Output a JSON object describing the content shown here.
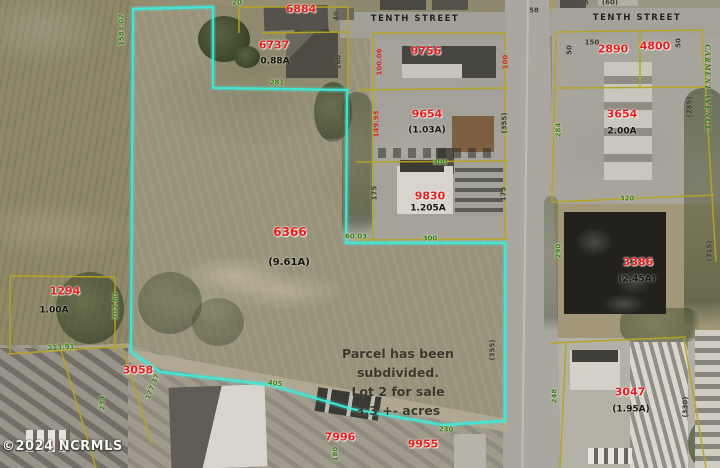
{
  "watermark": "©2024 NCRMLS",
  "annotation": {
    "line1": "Parcel has been subdivided.",
    "line2": "Lot 2 for sale",
    "line3": "3.3 +- acres"
  },
  "subject_parcel": {
    "id": "6366",
    "acreage": "(9.61A)"
  },
  "streets": [
    "TENTH STREET",
    "TENTH STREET",
    "CARMENT AVENUE"
  ],
  "colors": {
    "subject_outline": "#3fe8d7",
    "parcel_line": "#b7a51f",
    "parcel_id_red": "#e61c1c",
    "dim_green": "#33761c",
    "dim_dark": "#39392e"
  },
  "map": {
    "labels": [
      {
        "text": "TENTH STREET",
        "x": 415,
        "y": 19,
        "cls": "street",
        "size": 8.5,
        "sp": 1.5,
        "name": "street-label-tenth-street-west"
      },
      {
        "text": "TENTH STREET",
        "x": 637,
        "y": 18,
        "cls": "street",
        "size": 8.5,
        "sp": 1.5,
        "name": "street-label-tenth-street-east"
      },
      {
        "text": "CARMENT AVENUE",
        "x": 707,
        "y": 88,
        "rot": 90,
        "cls": "avenue",
        "size": 8,
        "sp": 1,
        "name": "street-label-carment-avenue"
      },
      {
        "text": "6884",
        "x": 301,
        "y": 9,
        "cls": "red",
        "size": 11,
        "name": "parcel-id-6884"
      },
      {
        "text": "6737",
        "x": 274,
        "y": 45,
        "cls": "red",
        "size": 11,
        "name": "parcel-id-6737"
      },
      {
        "text": "0.88A",
        "x": 275,
        "y": 62,
        "cls": "black",
        "size": 9,
        "name": "acreage-6737"
      },
      {
        "text": "9756",
        "x": 426,
        "y": 51,
        "cls": "red",
        "size": 11,
        "name": "parcel-id-9756"
      },
      {
        "text": "9654",
        "x": 427,
        "y": 114,
        "cls": "red",
        "size": 11,
        "name": "parcel-id-9654"
      },
      {
        "text": "(1.03A)",
        "x": 427,
        "y": 131,
        "cls": "black",
        "size": 9,
        "name": "acreage-9654"
      },
      {
        "text": "9830",
        "x": 430,
        "y": 196,
        "cls": "red",
        "size": 11,
        "name": "parcel-id-9830"
      },
      {
        "text": "1.205A",
        "x": 428,
        "y": 209,
        "cls": "black",
        "size": 9,
        "name": "acreage-9830"
      },
      {
        "text": "6366",
        "x": 290,
        "y": 232,
        "cls": "red",
        "size": 12,
        "name": "parcel-id-6366"
      },
      {
        "text": "(9.61A)",
        "x": 289,
        "y": 263,
        "cls": "black",
        "size": 10,
        "name": "acreage-6366"
      },
      {
        "text": "1294",
        "x": 65,
        "y": 291,
        "cls": "red",
        "size": 11,
        "name": "parcel-id-1294"
      },
      {
        "text": "1.00A",
        "x": 54,
        "y": 311,
        "cls": "black",
        "size": 9,
        "name": "acreage-1294"
      },
      {
        "text": "3058",
        "x": 138,
        "y": 370,
        "cls": "red",
        "size": 11,
        "name": "parcel-id-3058"
      },
      {
        "text": "7996",
        "x": 340,
        "y": 437,
        "cls": "red",
        "size": 11,
        "name": "parcel-id-7996"
      },
      {
        "text": "9955",
        "x": 423,
        "y": 444,
        "cls": "red",
        "size": 11,
        "name": "parcel-id-9955"
      },
      {
        "text": "2890",
        "x": 613,
        "y": 49,
        "cls": "red",
        "size": 11,
        "name": "parcel-id-2890"
      },
      {
        "text": "4800",
        "x": 655,
        "y": 46,
        "cls": "red",
        "size": 11,
        "name": "parcel-id-4800"
      },
      {
        "text": "3654",
        "x": 622,
        "y": 114,
        "cls": "red",
        "size": 11,
        "name": "parcel-id-3654"
      },
      {
        "text": "2.00A",
        "x": 622,
        "y": 132,
        "cls": "black",
        "size": 9,
        "name": "acreage-3654"
      },
      {
        "text": "3386",
        "x": 638,
        "y": 262,
        "cls": "red",
        "size": 11,
        "name": "parcel-id-3386"
      },
      {
        "text": "(2.45A)",
        "x": 637,
        "y": 280,
        "cls": "black",
        "size": 9,
        "name": "acreage-3386"
      },
      {
        "text": "3047",
        "x": 630,
        "y": 392,
        "cls": "red",
        "size": 11,
        "name": "parcel-id-3047"
      },
      {
        "text": "(1.95A)",
        "x": 631,
        "y": 410,
        "cls": "black",
        "size": 9,
        "name": "acreage-3047"
      },
      {
        "text": "1583.07",
        "x": 122,
        "y": 30,
        "rot": -90,
        "cls": "green",
        "size": 7,
        "name": "dim-1583-07"
      },
      {
        "text": "20",
        "x": 237,
        "y": 3,
        "cls": "green",
        "size": 7,
        "name": "dim-20"
      },
      {
        "text": "281",
        "x": 277,
        "y": 83,
        "cls": "green",
        "size": 7,
        "name": "dim-281"
      },
      {
        "text": "60.03",
        "x": 356,
        "y": 237,
        "cls": "green",
        "size": 7,
        "name": "dim-60-03"
      },
      {
        "text": "300",
        "x": 440,
        "y": 163,
        "cls": "green",
        "size": 7,
        "name": "dim-300-upper"
      },
      {
        "text": "300",
        "x": 430,
        "y": 239,
        "cls": "green",
        "size": 7,
        "name": "dim-300-lower"
      },
      {
        "text": "202.80",
        "x": 116,
        "y": 306,
        "rot": -90,
        "cls": "green",
        "size": 7,
        "name": "dim-202-80"
      },
      {
        "text": "213.91",
        "x": 61,
        "y": 348,
        "rot": -4,
        "cls": "green",
        "size": 7,
        "name": "dim-213-91"
      },
      {
        "text": "234",
        "x": 103,
        "y": 403,
        "rot": -90,
        "cls": "green",
        "size": 7,
        "name": "dim-234"
      },
      {
        "text": "177.37",
        "x": 153,
        "y": 387,
        "rot": -68,
        "cls": "green",
        "size": 7,
        "name": "dim-177-37"
      },
      {
        "text": "405",
        "x": 275,
        "y": 384,
        "rot": 7,
        "cls": "green",
        "size": 7,
        "name": "dim-405"
      },
      {
        "text": "180",
        "x": 336,
        "y": 454,
        "rot": -90,
        "cls": "green",
        "size": 7,
        "name": "dim-180"
      },
      {
        "text": "230",
        "x": 446,
        "y": 430,
        "rot": 2,
        "cls": "green",
        "size": 7,
        "name": "dim-230"
      },
      {
        "text": "284",
        "x": 559,
        "y": 130,
        "rot": -90,
        "cls": "green",
        "size": 7,
        "name": "dim-284"
      },
      {
        "text": "320",
        "x": 627,
        "y": 199,
        "cls": "green",
        "size": 7,
        "name": "dim-320"
      },
      {
        "text": "290",
        "x": 559,
        "y": 251,
        "rot": -90,
        "cls": "green",
        "size": 7,
        "name": "dim-290"
      },
      {
        "text": "248",
        "x": 555,
        "y": 396,
        "rot": -90,
        "cls": "green",
        "size": 7,
        "name": "dim-248"
      },
      {
        "text": "40",
        "x": 337,
        "y": 16,
        "rot": -90,
        "cls": "dark",
        "size": 7,
        "name": "dim-40"
      },
      {
        "text": "160",
        "x": 339,
        "y": 62,
        "rot": -90,
        "cls": "dark",
        "size": 7,
        "name": "dim-160"
      },
      {
        "text": "58",
        "x": 534,
        "y": 11,
        "cls": "dark",
        "size": 7,
        "name": "dim-58"
      },
      {
        "text": "75",
        "x": 584,
        "y": 3,
        "cls": "dark",
        "size": 7,
        "name": "dim-75"
      },
      {
        "text": "(60)",
        "x": 610,
        "y": 3,
        "cls": "dark",
        "size": 7,
        "name": "dim-60"
      },
      {
        "text": "50",
        "x": 570,
        "y": 50,
        "rot": -90,
        "cls": "dark",
        "size": 7,
        "name": "dim-50-west"
      },
      {
        "text": "150",
        "x": 592,
        "y": 43,
        "cls": "dark",
        "size": 7,
        "name": "dim-150"
      },
      {
        "text": "50",
        "x": 679,
        "y": 43,
        "rot": -90,
        "cls": "dark",
        "size": 7,
        "name": "dim-50-east"
      },
      {
        "text": "(285)",
        "x": 690,
        "y": 107,
        "rot": -90,
        "cls": "dark",
        "size": 7,
        "name": "dim-285"
      },
      {
        "text": "(355)",
        "x": 505,
        "y": 123,
        "rot": -90,
        "cls": "dark",
        "size": 7,
        "name": "dim-355-upper"
      },
      {
        "text": "175",
        "x": 375,
        "y": 193,
        "rot": -90,
        "cls": "dark",
        "size": 7,
        "name": "dim-175-west"
      },
      {
        "text": "175",
        "x": 504,
        "y": 194,
        "rot": -90,
        "cls": "dark",
        "size": 7,
        "name": "dim-175-east"
      },
      {
        "text": "(355)",
        "x": 493,
        "y": 350,
        "rot": -90,
        "cls": "dark",
        "size": 7,
        "name": "dim-355-lower"
      },
      {
        "text": "(315)",
        "x": 710,
        "y": 251,
        "rot": -90,
        "cls": "dark",
        "size": 7,
        "name": "dim-315"
      },
      {
        "text": "(330)",
        "x": 686,
        "y": 407,
        "rot": -90,
        "cls": "dark",
        "size": 7,
        "name": "dim-330"
      },
      {
        "text": "100.06",
        "x": 380,
        "y": 62,
        "rot": -90,
        "cls": "reddim",
        "size": 7,
        "name": "dim-100-06"
      },
      {
        "text": "100",
        "x": 506,
        "y": 62,
        "rot": -90,
        "cls": "reddim",
        "size": 7,
        "name": "dim-100"
      },
      {
        "text": "149.93",
        "x": 377,
        "y": 124,
        "rot": -90,
        "cls": "reddim",
        "size": 7,
        "name": "dim-149-93"
      }
    ],
    "boundaries": {
      "subject_outline_points": "133,9 213,7 213,88 347,90 346,243 505,243 505,421 443,425 352,409 271,385 160,372 131,352",
      "yellow_segments": [
        [
          239,
          7,
          348,
          7
        ],
        [
          239,
          7,
          239,
          33
        ],
        [
          262,
          33,
          348,
          32
        ],
        [
          348,
          7,
          348,
          90
        ],
        [
          373,
          33,
          505,
          33
        ],
        [
          373,
          33,
          373,
          240
        ],
        [
          358,
          90,
          508,
          88
        ],
        [
          505,
          33,
          505,
          240
        ],
        [
          356,
          162,
          508,
          161
        ],
        [
          356,
          240,
          508,
          239
        ],
        [
          10,
          276,
          115,
          277
        ],
        [
          10,
          276,
          10,
          353
        ],
        [
          115,
          277,
          115,
          352
        ],
        [
          8,
          354,
          126,
          346
        ],
        [
          122,
          348,
          152,
          444
        ],
        [
          60,
          347,
          96,
          468
        ],
        [
          556,
          32,
          702,
          30
        ],
        [
          640,
          31,
          640,
          88
        ],
        [
          557,
          88,
          706,
          87
        ],
        [
          556,
          32,
          552,
          202
        ],
        [
          702,
          30,
          716,
          262
        ],
        [
          552,
          202,
          714,
          195
        ],
        [
          550,
          343,
          686,
          337
        ],
        [
          566,
          345,
          560,
          468
        ],
        [
          684,
          339,
          706,
          468
        ],
        [
          552,
          0,
          552,
          12
        ]
      ]
    }
  }
}
